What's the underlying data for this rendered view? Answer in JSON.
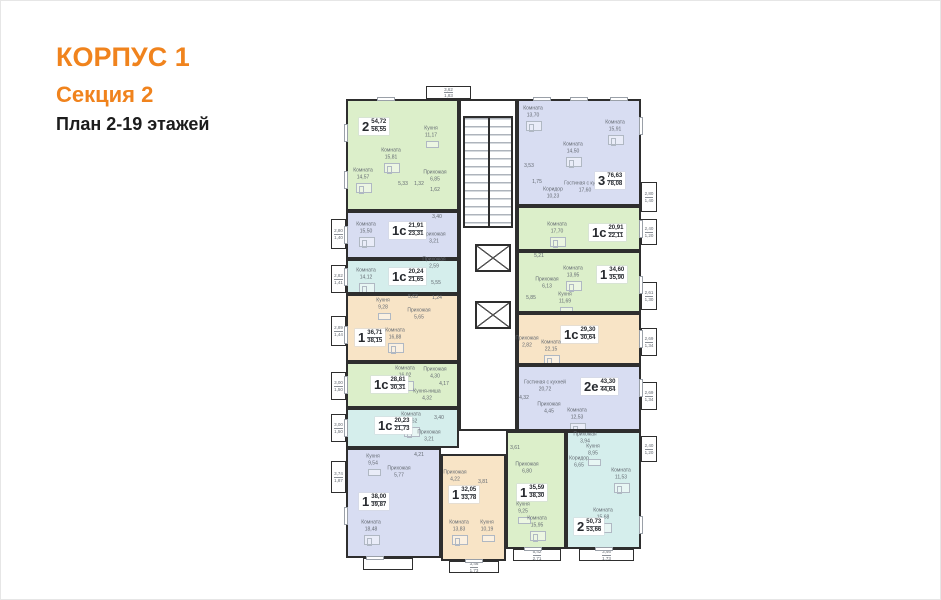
{
  "header": {
    "building": "КОРПУС 1",
    "section": "Секция 2",
    "plan": "План 2-19 этажей"
  },
  "palette": {
    "accent": "#f0831d",
    "wall": "#2e2e2e",
    "room_text": "#646a72",
    "green": "#dcefca",
    "lavender": "#d8ddf2",
    "cyan": "#d5eeec",
    "peach": "#f8e4c6"
  },
  "apartments": [
    {
      "id": "2-rooms-top",
      "number": "2",
      "area_main": "54,72",
      "area_total": "56,55",
      "color": "green",
      "rect": [
        15,
        13,
        113,
        112
      ],
      "badge": [
        28,
        32
      ],
      "rooms": [
        [
          "Комната",
          "15,81",
          60,
          68
        ],
        [
          "Комната",
          "14,57",
          32,
          88
        ],
        [
          "Кухня",
          "11,17",
          100,
          46
        ],
        [
          "Прихожая",
          "6,85",
          104,
          90
        ],
        [
          "",
          "5,33",
          72,
          98
        ],
        [
          "",
          "1,32",
          88,
          98
        ],
        [
          "",
          "1,62",
          104,
          104
        ]
      ],
      "balconies": [
        [
          95,
          0,
          45,
          13,
          "3,62",
          "1,83"
        ]
      ],
      "windows": [
        [
          "left",
          0.3
        ],
        [
          "left",
          0.72
        ],
        [
          "top",
          0.35
        ]
      ]
    },
    {
      "id": "1s-a",
      "number": "1с",
      "area_main": "21,91",
      "area_total": "23,31",
      "color": "lavender",
      "rect": [
        15,
        125,
        113,
        48
      ],
      "badge": [
        58,
        136
      ],
      "rooms": [
        [
          "Комната",
          "15,50",
          35,
          142
        ],
        [
          "Прихожая",
          "3,21",
          103,
          152
        ],
        [
          "",
          "3,40",
          106,
          131
        ]
      ],
      "balconies": [
        [
          0,
          133,
          15,
          30,
          "2,80",
          "1,40"
        ]
      ],
      "windows": [
        [
          "left",
          0.5
        ]
      ]
    },
    {
      "id": "1s-b",
      "number": "1с",
      "area_main": "20,24",
      "area_total": "21,65",
      "color": "cyan",
      "rect": [
        15,
        173,
        113,
        35
      ],
      "badge": [
        58,
        182
      ],
      "rooms": [
        [
          "Комната",
          "14,12",
          35,
          188
        ],
        [
          "Прихожая",
          "2,59",
          103,
          177
        ],
        [
          "",
          "5,55",
          105,
          197
        ]
      ],
      "balconies": [
        [
          0,
          179,
          15,
          28,
          "2,82",
          "1,41"
        ]
      ],
      "windows": [
        [
          "left",
          0.5
        ]
      ]
    },
    {
      "id": "1-a",
      "number": "1",
      "area_main": "36,71",
      "area_total": "38,15",
      "color": "peach",
      "rect": [
        15,
        208,
        113,
        68
      ],
      "badge": [
        24,
        243
      ],
      "rooms": [
        [
          "Кухня",
          "9,28",
          52,
          218
        ],
        [
          "Комната",
          "16,88",
          64,
          248
        ],
        [
          "Прихожая",
          "5,65",
          88,
          228
        ],
        [
          "",
          "5,63",
          82,
          211
        ],
        [
          "",
          "1,24",
          106,
          212
        ]
      ],
      "balconies": [
        [
          0,
          230,
          15,
          30,
          "2,89",
          "1,44"
        ]
      ],
      "windows": [
        [
          "left",
          0.6
        ]
      ]
    },
    {
      "id": "1s-c",
      "number": "1с",
      "area_main": "28,81",
      "area_total": "30,31",
      "color": "green",
      "rect": [
        15,
        276,
        113,
        46
      ],
      "badge": [
        40,
        290
      ],
      "rooms": [
        [
          "Комната",
          "16,02",
          74,
          286
        ],
        [
          "Кухня-ниша",
          "4,32",
          96,
          309
        ],
        [
          "Прихожая",
          "4,30",
          104,
          287
        ],
        [
          "",
          "4,17",
          113,
          298
        ]
      ],
      "balconies": [
        [
          0,
          286,
          15,
          28,
          "3,00",
          "1,50"
        ]
      ],
      "windows": [
        [
          "left",
          0.5
        ]
      ]
    },
    {
      "id": "1s-d",
      "number": "1с",
      "area_main": "20,23",
      "area_total": "21,73",
      "color": "cyan",
      "rect": [
        15,
        322,
        113,
        40
      ],
      "badge": [
        44,
        331
      ],
      "rooms": [
        [
          "Комната",
          "13,62",
          80,
          332
        ],
        [
          "Прихожая",
          "3,21",
          98,
          350
        ],
        [
          "",
          "3,40",
          108,
          332
        ]
      ],
      "balconies": [
        [
          0,
          328,
          15,
          28,
          "3,00",
          "1,50"
        ]
      ],
      "windows": [
        [
          "left",
          0.5
        ]
      ]
    },
    {
      "id": "1-b",
      "number": "1",
      "area_main": "38,00",
      "area_total": "39,87",
      "color": "lavender",
      "rect": [
        15,
        362,
        95,
        110
      ],
      "badge": [
        28,
        407
      ],
      "rooms": [
        [
          "Кухня",
          "9,54",
          42,
          374
        ],
        [
          "Комната",
          "18,48",
          40,
          440
        ],
        [
          "Прихожая",
          "5,77",
          68,
          386
        ],
        [
          "",
          "4,21",
          88,
          369
        ]
      ],
      "balconies": [
        [
          0,
          375,
          15,
          32,
          "3,74",
          "1,87"
        ],
        [
          32,
          472,
          50,
          12,
          "",
          ""
        ]
      ],
      "windows": [
        [
          "left",
          0.62
        ],
        [
          "bottom",
          0.3
        ]
      ]
    },
    {
      "id": "1-c",
      "number": "1",
      "area_main": "32,05",
      "area_total": "33,78",
      "color": "peach",
      "rect": [
        110,
        368,
        65,
        107
      ],
      "badge": [
        118,
        400
      ],
      "rooms": [
        [
          "Прихожая",
          "4,22",
          124,
          390
        ],
        [
          "",
          "3,81",
          152,
          396
        ],
        [
          "Комната",
          "13,83",
          128,
          440
        ],
        [
          "Кухня",
          "10,19",
          156,
          440
        ]
      ],
      "balconies": [
        [
          118,
          475,
          50,
          12,
          "3,46",
          "1,73"
        ]
      ],
      "windows": [
        [
          "bottom",
          0.5
        ]
      ]
    },
    {
      "id": "1-d",
      "number": "1",
      "area_main": "35,59",
      "area_total": "38,30",
      "color": "green",
      "rect": [
        175,
        345,
        60,
        118
      ],
      "badge": [
        186,
        398
      ],
      "rooms": [
        [
          "Прихожая",
          "6,80",
          196,
          382
        ],
        [
          "Кухня",
          "9,25",
          192,
          422
        ],
        [
          "Комната",
          "15,95",
          206,
          436
        ],
        [
          "",
          "3,61",
          184,
          362
        ]
      ],
      "balconies": [
        [
          182,
          463,
          48,
          12,
          "5,42",
          "2,71"
        ]
      ],
      "windows": [
        [
          "bottom",
          0.45
        ]
      ]
    },
    {
      "id": "2-rooms-bottom",
      "number": "2",
      "area_main": "50,73",
      "area_total": "53,66",
      "color": "cyan",
      "rect": [
        235,
        345,
        75,
        118
      ],
      "badge": [
        243,
        432
      ],
      "rooms": [
        [
          "Прихожая",
          "3,94",
          254,
          352
        ],
        [
          "Кухня",
          "8,95",
          262,
          364
        ],
        [
          "Коридор",
          "6,65",
          248,
          376
        ],
        [
          "Комната",
          "11,53",
          290,
          388
        ],
        [
          "Комната",
          "15,68",
          272,
          428
        ]
      ],
      "balconies": [
        [
          310,
          350,
          16,
          26,
          "2,40",
          "1,20"
        ],
        [
          248,
          463,
          55,
          12,
          "3,46",
          "1,73"
        ]
      ],
      "windows": [
        [
          "bottom",
          0.5
        ],
        [
          "right",
          0.8
        ]
      ]
    },
    {
      "id": "2e",
      "number": "2е",
      "area_main": "43,30",
      "area_total": "44,64",
      "color": "lavender",
      "rect": [
        186,
        279,
        124,
        66
      ],
      "badge": [
        250,
        292
      ],
      "rooms": [
        [
          "Гостиная с кухней",
          "20,72",
          214,
          300
        ],
        [
          "Комната",
          "12,53",
          246,
          328
        ],
        [
          "Прихожая",
          "4,45",
          218,
          322
        ],
        [
          "",
          "4,32",
          193,
          312
        ]
      ],
      "balconies": [
        [
          310,
          296,
          16,
          28,
          "2,69",
          "1,34"
        ]
      ],
      "windows": [
        [
          "right",
          0.35
        ]
      ]
    },
    {
      "id": "1s-e",
      "number": "1с",
      "area_main": "29,30",
      "area_total": "30,64",
      "color": "peach",
      "rect": [
        186,
        227,
        124,
        52
      ],
      "badge": [
        230,
        240
      ],
      "rooms": [
        [
          "Комната",
          "22,15",
          220,
          260
        ],
        [
          "Прихожая",
          "2,82",
          196,
          256
        ]
      ],
      "balconies": [
        [
          310,
          242,
          16,
          28,
          "2,69",
          "1,34"
        ]
      ],
      "windows": [
        [
          "right",
          0.5
        ]
      ]
    },
    {
      "id": "1-e",
      "number": "1",
      "area_main": "34,60",
      "area_total": "35,90",
      "color": "green",
      "rect": [
        186,
        165,
        124,
        62
      ],
      "badge": [
        266,
        180
      ],
      "rooms": [
        [
          "Комната",
          "13,95",
          242,
          186
        ],
        [
          "Кухня",
          "11,69",
          234,
          212
        ],
        [
          "Прихожая",
          "6,13",
          216,
          197
        ],
        [
          "",
          "5,85",
          200,
          212
        ],
        [
          "",
          "5,21",
          208,
          170
        ]
      ],
      "balconies": [
        [
          310,
          196,
          16,
          28,
          "2,61",
          "1,30"
        ]
      ],
      "windows": [
        [
          "right",
          0.55
        ]
      ]
    },
    {
      "id": "1s-f",
      "number": "1с",
      "area_main": "20,91",
      "area_total": "22,11",
      "color": "green",
      "rect": [
        186,
        120,
        124,
        45
      ],
      "badge": [
        258,
        138
      ],
      "rooms": [
        [
          "Комната",
          "17,70",
          226,
          142
        ]
      ],
      "balconies": [
        [
          310,
          133,
          16,
          26,
          "2,40",
          "1,20"
        ]
      ],
      "windows": [
        [
          "right",
          0.5
        ]
      ]
    },
    {
      "id": "3-rooms",
      "number": "3",
      "area_main": "76,63",
      "area_total": "78,08",
      "color": "lavender",
      "rect": [
        186,
        13,
        124,
        107
      ],
      "badge": [
        264,
        86
      ],
      "rooms": [
        [
          "Комната",
          "13,70",
          202,
          26
        ],
        [
          "Комната",
          "14,50",
          242,
          62
        ],
        [
          "Комната",
          "15,91",
          284,
          40
        ],
        [
          "Гостиная с кухней",
          "17,60",
          254,
          101
        ],
        [
          "Коридор",
          "10,23",
          222,
          107
        ],
        [
          "",
          "3,53",
          198,
          80
        ],
        [
          "",
          "1,75",
          206,
          96
        ]
      ],
      "balconies": [
        [
          310,
          96,
          16,
          30,
          "2,80",
          "1,40"
        ]
      ],
      "windows": [
        [
          "top",
          0.2
        ],
        [
          "top",
          0.5
        ],
        [
          "top",
          0.82
        ],
        [
          "right",
          0.25
        ]
      ]
    }
  ]
}
